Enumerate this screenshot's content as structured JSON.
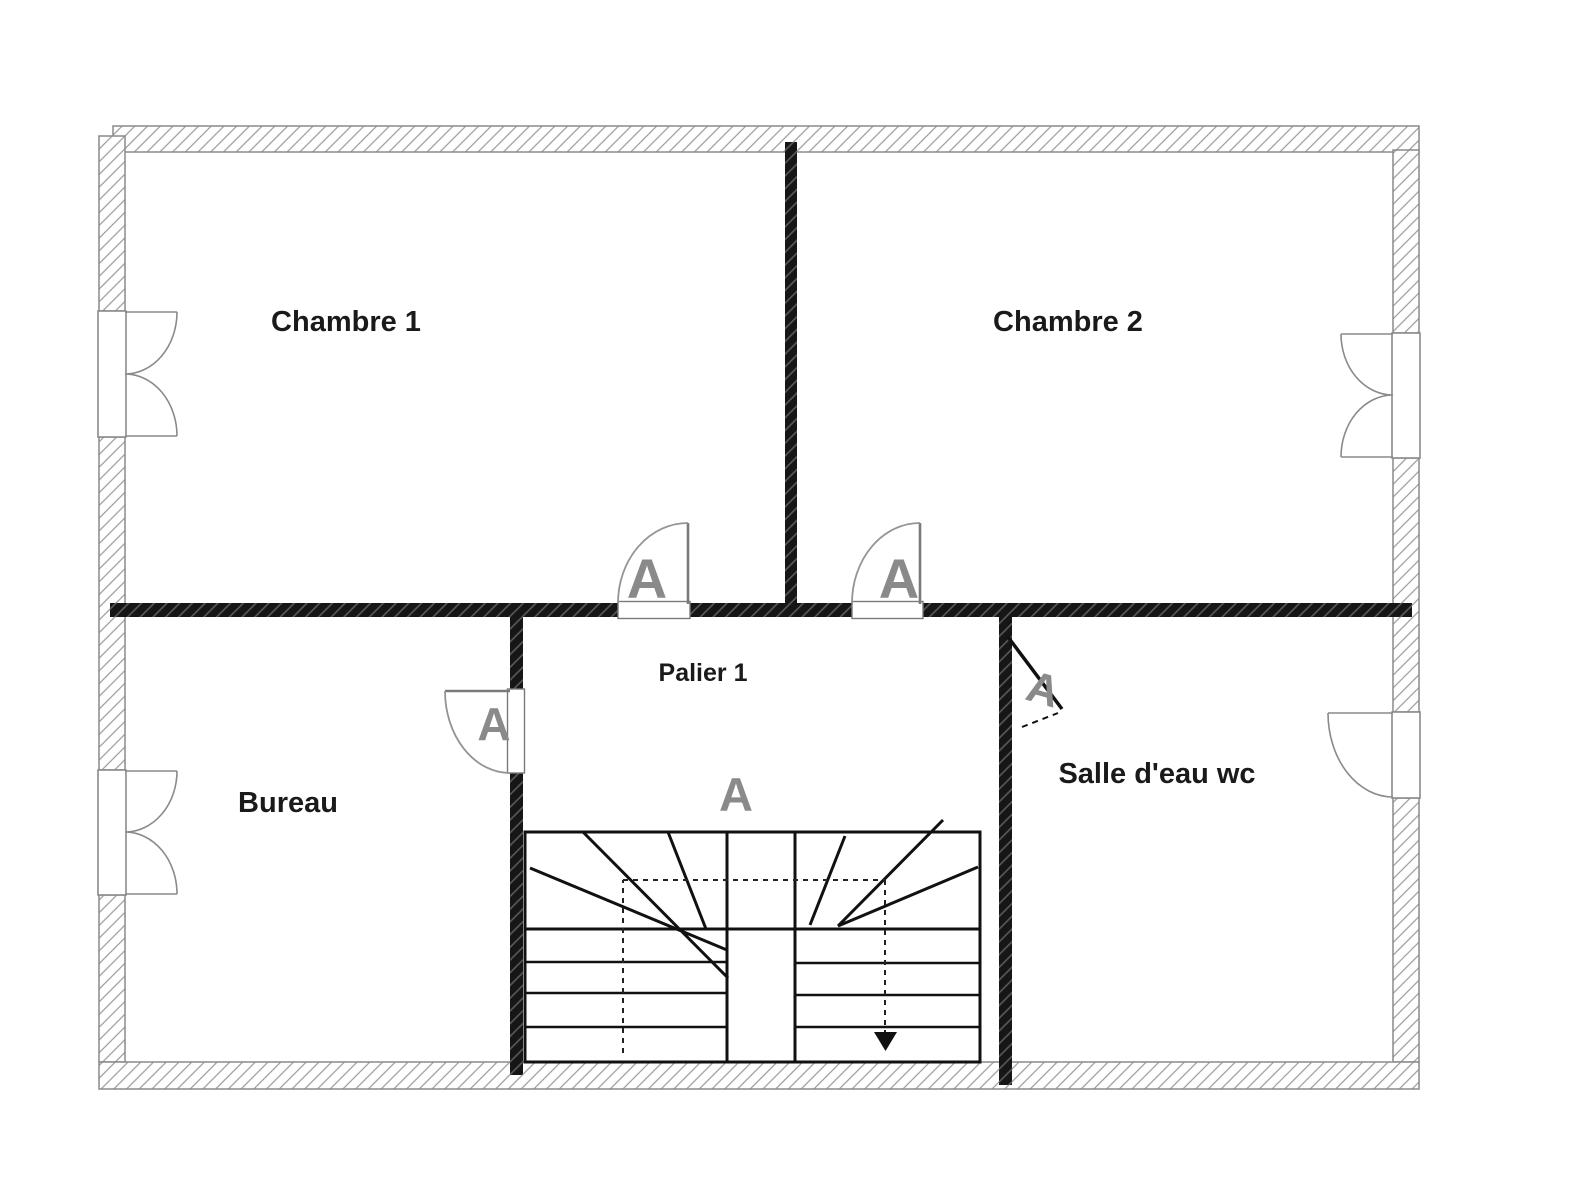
{
  "plan": {
    "rooms": [
      {
        "name": "Chambre 1"
      },
      {
        "name": "Chambre 2"
      },
      {
        "name": "Bureau"
      },
      {
        "name": "Palier 1"
      },
      {
        "name": "Salle d'eau wc"
      }
    ],
    "door_swing_label": "A",
    "stair_label": "A",
    "colors": {
      "background": "#ffffff",
      "outer_wall_hatch": "#999999",
      "outer_wall_outline": "#8a8a8a",
      "interior_wall": "#161616",
      "interior_wall_hatch": "#5e5e5e",
      "stair_line": "#111111",
      "swing_label_gray": "#8a8a8a",
      "text": "#1a1a1a"
    }
  }
}
